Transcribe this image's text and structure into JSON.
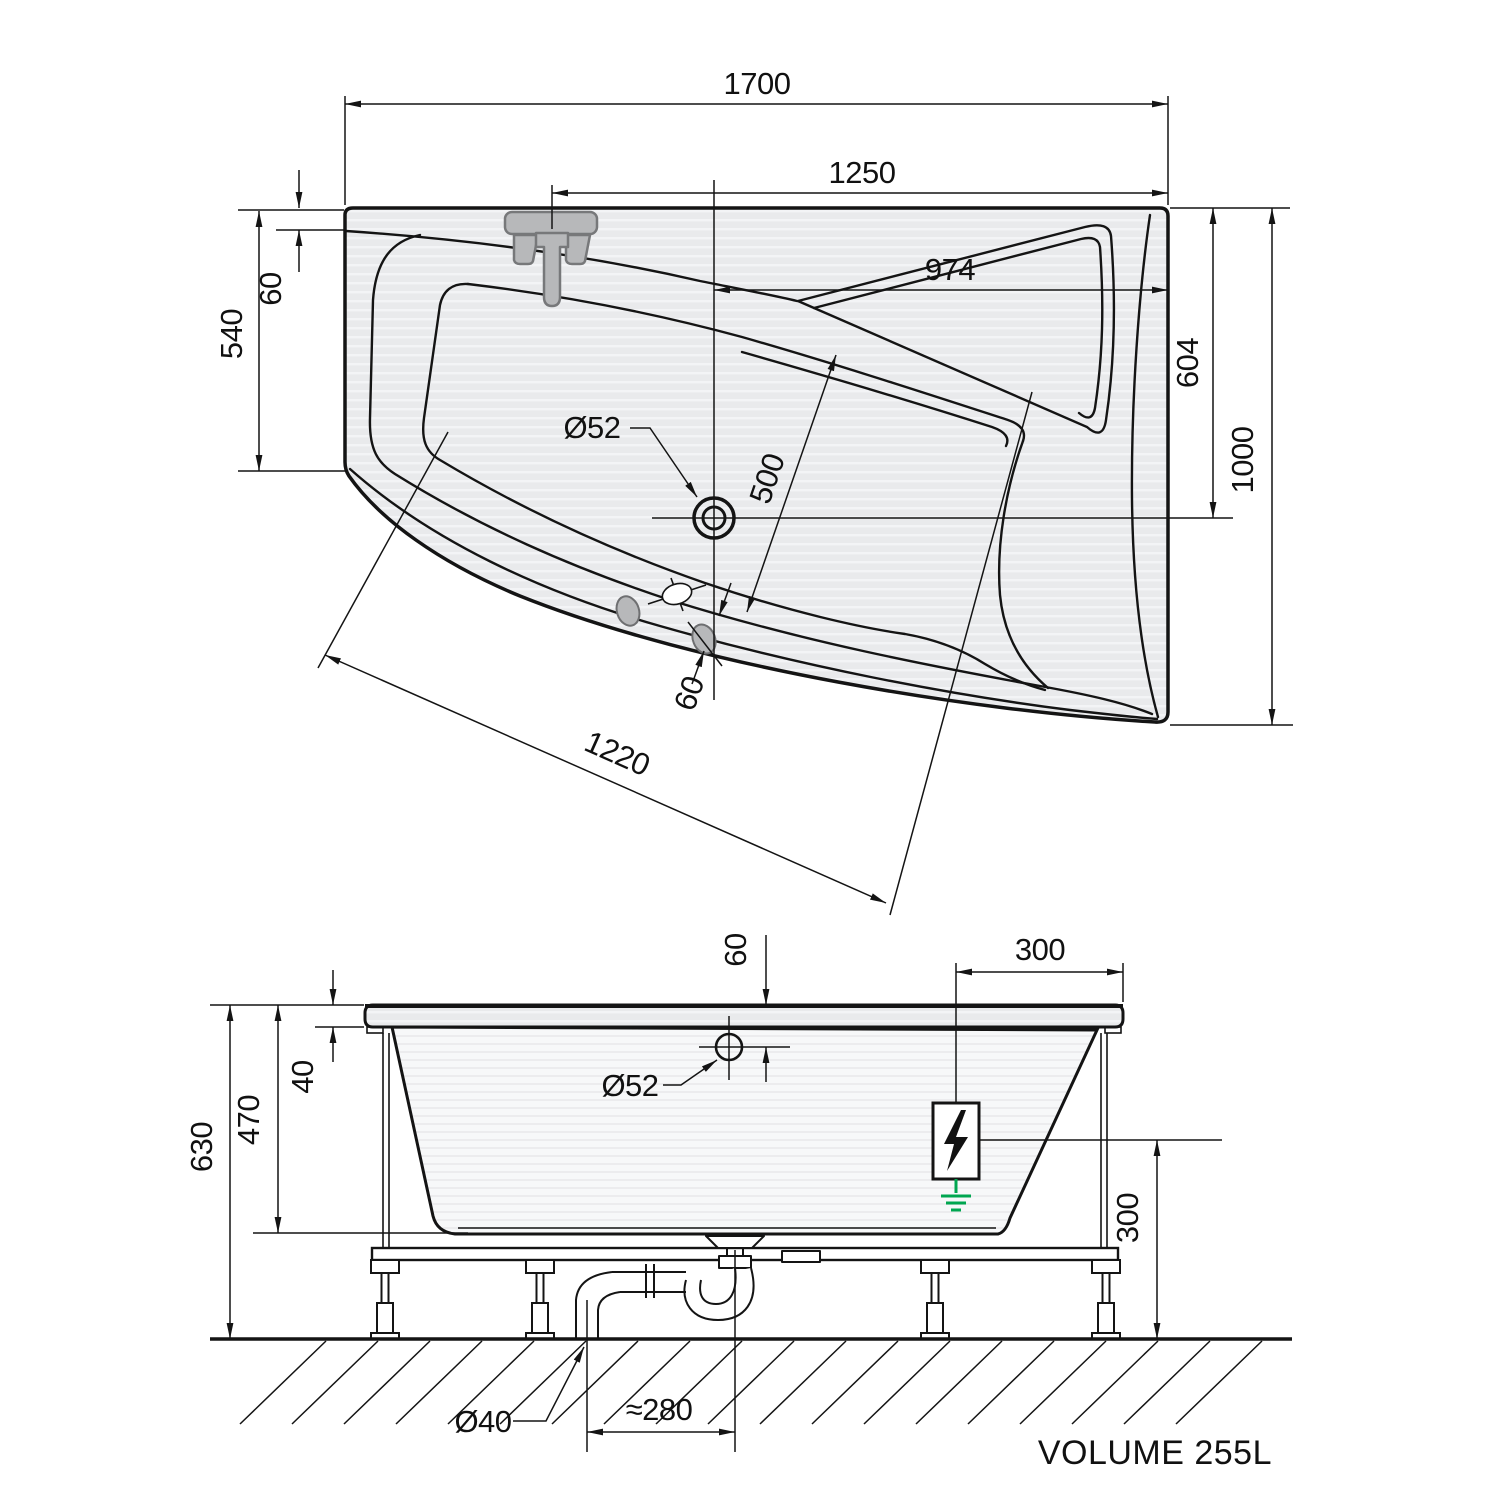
{
  "drawing": {
    "type": "bathtub technical drawing, plan and elevation",
    "line_color": "#141414",
    "fill_color": "#e9eaec",
    "accent_green": "#00a650"
  },
  "plan": {
    "overall_length": "1700",
    "faucet_to_right": "1250",
    "drain_to_right": "974",
    "faucet_edge_offset": "60",
    "left_side_depth": "540",
    "drain_from_back": "604",
    "overall_width": "1000",
    "drain_diameter": "Ø52",
    "backrest_width": "500",
    "basin_diagonal": "1220",
    "jet_offset": "60"
  },
  "side": {
    "overall_height": "630",
    "shell_height": "470",
    "rim_thickness": "40",
    "drain_top_offset": "60",
    "drain_diameter": "Ø52",
    "electrical_inset": "300",
    "electrical_height": "300",
    "waste_diameter": "Ø40",
    "trap_offset": "≈280"
  },
  "footer": {
    "volume": "VOLUME 255L"
  }
}
